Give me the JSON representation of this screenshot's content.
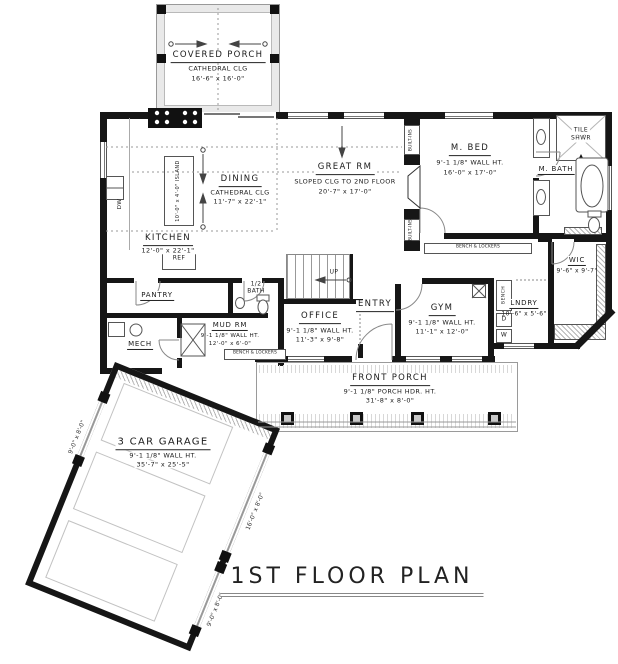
{
  "title": "1ST FLOOR PLAN",
  "rooms": {
    "covered_porch": {
      "name": "COVERED PORCH",
      "clg": "CATHEDRAL CLG",
      "dims": "16'-6\" x 16'-0\""
    },
    "great_rm": {
      "name": "GREAT RM",
      "clg": "SLOPED CLG TO 2ND FLOOR",
      "dims": "20'-7\" x 17'-0\""
    },
    "dining": {
      "name": "DINING",
      "clg": "CATHEDRAL CLG",
      "dims": "11'-7\" x 22'-1\""
    },
    "kitchen": {
      "name": "KITCHEN",
      "dims": "12'-0\" x 22'-1\""
    },
    "island": {
      "label": "10'-0\" x 4'-0\" ISLAND"
    },
    "m_bed": {
      "name": "M. BED",
      "wall_ht": "9'-1 1/8\" WALL HT.",
      "dims": "16'-0\" x 17'-0\""
    },
    "m_bath": {
      "name": "M. BATH"
    },
    "tile_shwr": {
      "line1": "TILE",
      "line2": "SHWR"
    },
    "wic": {
      "name": "WIC",
      "dims": "9'-6\" x 9'-7\""
    },
    "lndry": {
      "name": "LNDRY",
      "dims": "10'-6\" x 5'-6\""
    },
    "gym": {
      "name": "GYM",
      "wall_ht": "9'-1 1/8\" WALL HT.",
      "dims": "11'-1\" x 12'-0\""
    },
    "entry": {
      "name": "ENTRY"
    },
    "office": {
      "name": "OFFICE",
      "wall_ht": "9'-1 1/8\" WALL HT.",
      "dims": "11'-3\" x 9'-8\""
    },
    "mud_rm": {
      "name": "MUD RM",
      "wall_ht": "9'-1 1/8\" WALL HT.",
      "dims": "12'-0\" x 6'-0\""
    },
    "pantry": {
      "name": "PANTRY"
    },
    "mech": {
      "name": "MECH"
    },
    "half_bath": {
      "line1": "1/2",
      "line2": "BATH"
    },
    "front_porch": {
      "name": "FRONT PORCH",
      "hdr": "9'-1 1/8\" PORCH HDR. HT.",
      "dims": "31'-8\" x 8'-0\""
    },
    "garage": {
      "name": "3 CAR GARAGE",
      "wall_ht": "9'-1 1/8\" WALL HT.",
      "dims": "35'-7\" x 25'-5\"",
      "door_large": "16'-0\" x 8'-0\"",
      "door_small": "9'-0\" x 8'-0\""
    }
  },
  "fixtures": {
    "ref": "REF",
    "dw": "DW",
    "washer": "W",
    "dryer": "D",
    "bench": "BENCH",
    "built_ins": "BUILT-INS",
    "bench_lockers": "BENCH & LOCKERS",
    "up": "UP"
  },
  "colors": {
    "wall": "#161616",
    "hatch": "#b5b5b5",
    "text": "#1a1a1a"
  }
}
